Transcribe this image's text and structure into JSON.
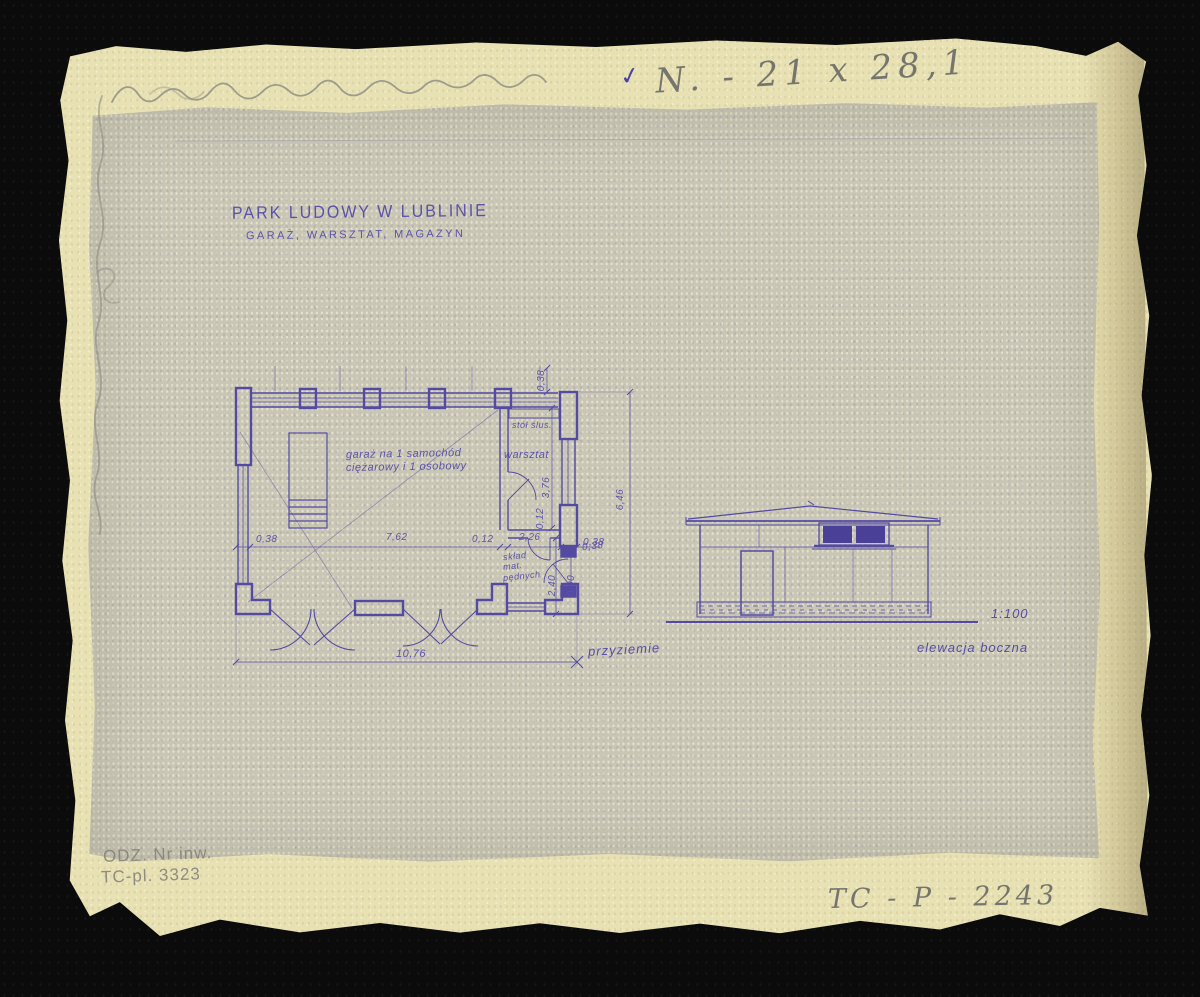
{
  "annotations": {
    "check": "✓",
    "size_note": "N. - 21 x 28,1",
    "inventory_line1": "ODZ. Nr inw.",
    "inventory_line2": "TC-pl. 3323",
    "catalog_number": "TC - P - 2243"
  },
  "title": {
    "line1": "PARK LUDOWY W LUBLINIE",
    "line2": "GARAŻ, WARSZTAT, MAGAZYN"
  },
  "floor_plan": {
    "caption": "przyziemie",
    "labels": {
      "garage_line1": "garaż na 1 samochód",
      "garage_line2": "ciężarowy i 1 osobowy",
      "workshop": "warsztat",
      "workbench": "stół ślus.",
      "fuel_store_line1": "skład",
      "fuel_store_line2": "mat.",
      "fuel_store_line3": "pędnych"
    },
    "dimensions": {
      "left_wall": "0,38",
      "garage_width": "7,62",
      "partition": "0,12",
      "workshop_width": "2,26",
      "right_wall": "0,38",
      "total_width": "10,76",
      "total_depth": "6,46",
      "wall_top": "0,38",
      "workshop_depth": "3,76",
      "inner_partition": "0,12",
      "store_depth": "2,40",
      "store_door": "0,90",
      "store_wall": "0,38"
    }
  },
  "elevation": {
    "caption": "elewacja boczna",
    "scale": "1:100"
  },
  "colors": {
    "ink": "#564ca6",
    "pencil": "#75756d",
    "paper": "#e8e1b3",
    "print_sheet": "#c9c6b5",
    "background": "#0b0b0b"
  }
}
